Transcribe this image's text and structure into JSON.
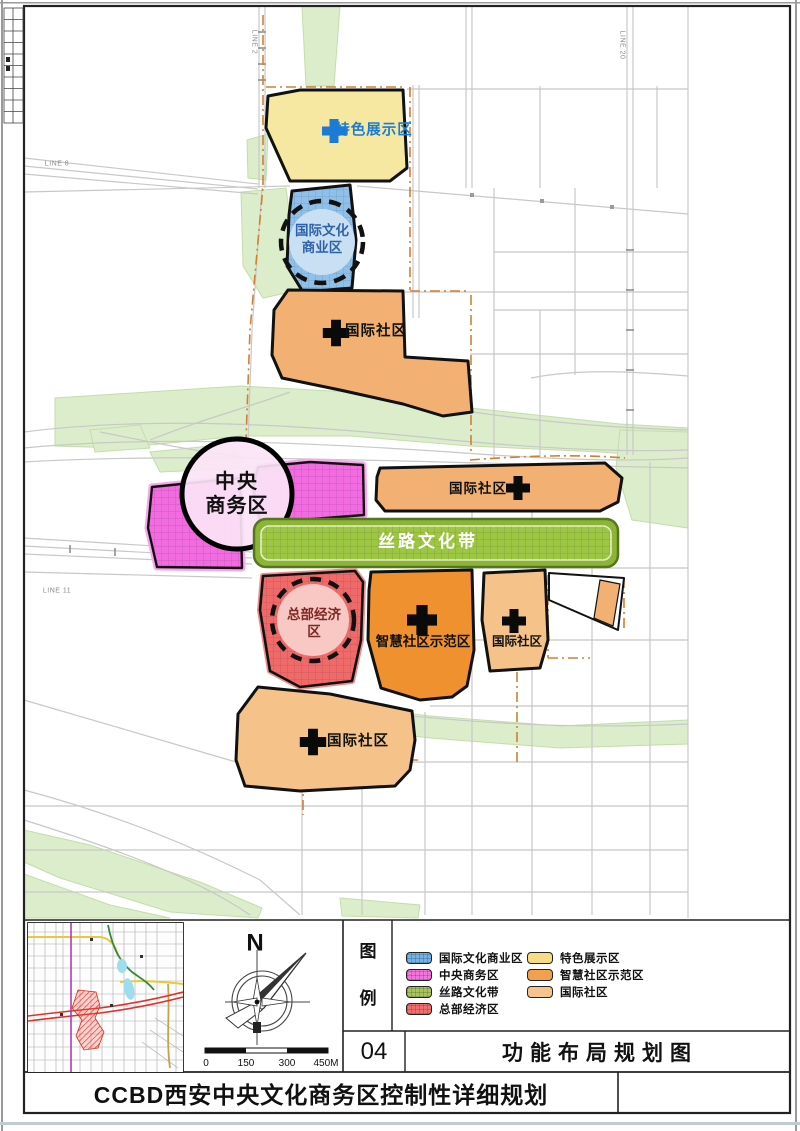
{
  "sheet": {
    "drawing_number": "04",
    "drawing_title": "功能布局规划图",
    "project_title": "CCBD西安中央文化商务区控制性详细规划"
  },
  "map": {
    "zone_labels": {
      "special_exhibition": "特色展示区",
      "intl_culture_line1": "国际文化",
      "intl_culture_line2": "商业区",
      "intl_community_top": "国际社区",
      "intl_community_mid": "国际社区",
      "cbd_line1": "中央",
      "cbd_line2": "商务区",
      "silk_road_belt": "丝路文化带",
      "hq_economy_line1": "总部经济",
      "hq_economy_line2": "区",
      "smart_community": "智慧社区示范区",
      "intl_community_small": "国际社区",
      "intl_community_bottom": "国际社区"
    },
    "rail_labels": {
      "line2": "LINE 2",
      "line8": "LINE 8",
      "line20": "LINE 20",
      "line11": "LINE 11"
    },
    "zone_fills": {
      "special_exhibition": "#F6E8A0",
      "intl_culture_commerce": "#8FC0EA",
      "intl_community": "#F2B172",
      "intl_community_light": "#F5C38A",
      "cbd_magenta": "#F26BE0",
      "silk_road_belt": "#9DC643",
      "hq_economy": "#F16A6A",
      "smart_community": "#F0912F",
      "park_green": "#DCEDCB",
      "cross_blue": "#1B7BD6",
      "cross_black": "#0a0a0a"
    }
  },
  "legend": {
    "header_top": "图",
    "header_bottom": "例",
    "items_left": [
      {
        "label": "国际文化商业区",
        "color": "#6FB3E8"
      },
      {
        "label": "中央商务区",
        "color": "#F275DE"
      },
      {
        "label": "丝路文化带",
        "color": "#A9C45C"
      },
      {
        "label": "总部经济区",
        "color": "#F07070"
      }
    ],
    "items_right": [
      {
        "label": "特色展示区",
        "color": "#F8DC84"
      },
      {
        "label": "智慧社区示范区",
        "color": "#F2A04E"
      },
      {
        "label": "国际社区",
        "color": "#F6C38C"
      }
    ]
  },
  "compass": {
    "north": "N"
  },
  "scale_bar": {
    "ticks": [
      "0",
      "150",
      "300",
      "450M"
    ]
  }
}
